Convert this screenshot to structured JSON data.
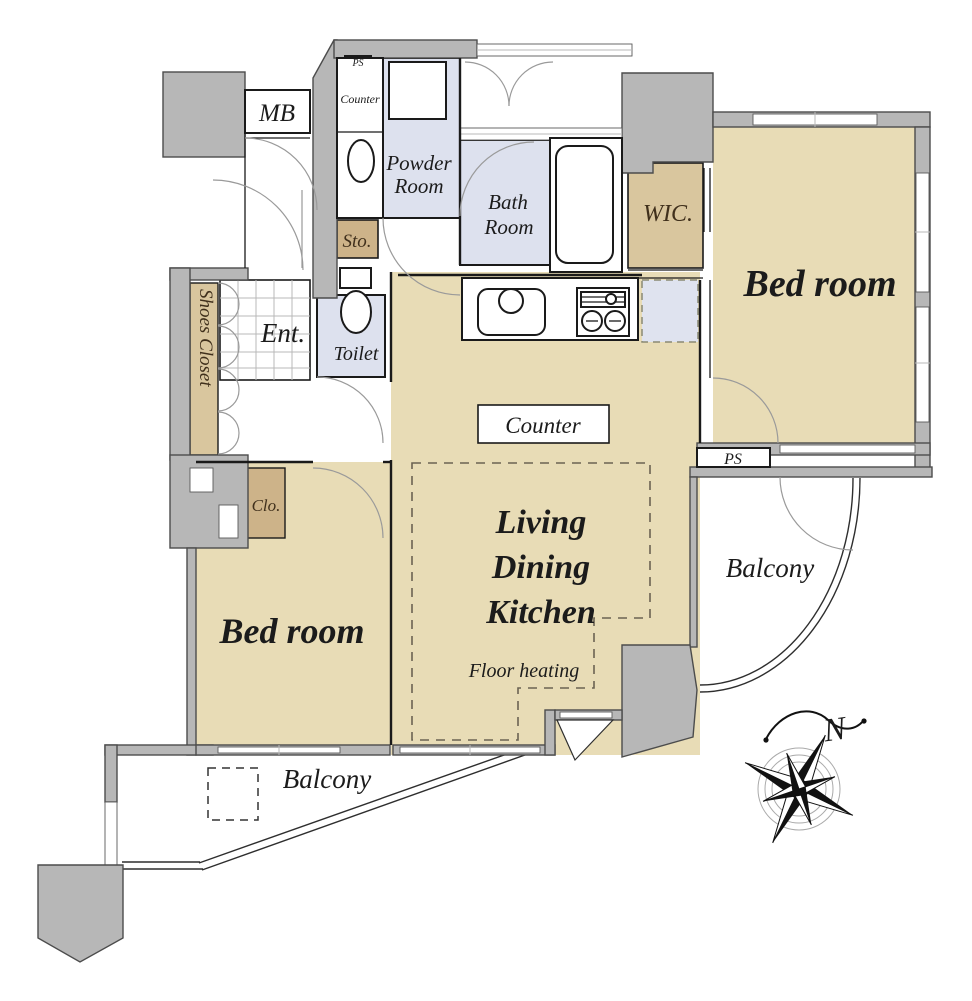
{
  "floorplan": {
    "labels": {
      "mb": "MB",
      "ps_top": "PS",
      "powder_counter": "Counter",
      "powder_line1": "Powder",
      "powder_line2": "Room",
      "bath_line1": "Bath",
      "bath_line2": "Room",
      "wic": "WIC.",
      "bedroom_main": "Bed room",
      "sto": "Sto.",
      "toilet": "Toilet",
      "ent": "Ent.",
      "shoes_closet": "Shoes Closet",
      "clo": "Clo.",
      "kitchen_counter": "Counter",
      "ldk_line1": "Living",
      "ldk_line2": "Dining",
      "ldk_line3": "Kitchen",
      "floor_heating": "Floor heating",
      "bedroom_second": "Bed room",
      "balcony_bottom": "Balcony",
      "balcony_right": "Balcony",
      "ps_bottom": "PS",
      "compass_north": "N"
    },
    "colors": {
      "wall_gray": "#b7b7b7",
      "room_tan": "#e8dcb6",
      "wic_tan": "#d9c69e",
      "closet_tan": "#cdb389",
      "wet_area_blue": "#dde1ee",
      "line_black": "#1a1a1a"
    }
  }
}
